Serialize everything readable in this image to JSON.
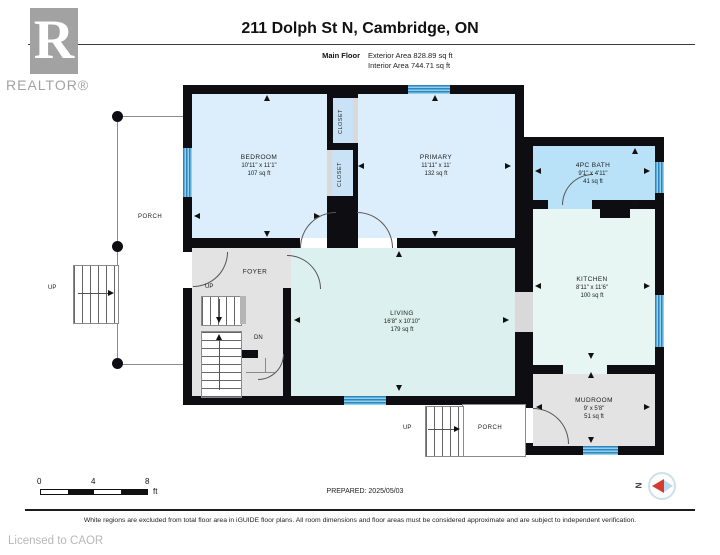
{
  "header": {
    "title": "211 Dolph St N, Cambridge, ON",
    "floor_label": "Main Floor",
    "exterior_area": "Exterior Area 828.89 sq ft",
    "interior_area": "Interior Area 744.71 sq ft"
  },
  "branding": {
    "logo_letter": "R",
    "logo_text": "REALTOR®"
  },
  "rooms": {
    "bedroom": {
      "name": "BEDROOM",
      "dims": "10'11\" x 11'1\"",
      "area": "107 sq ft"
    },
    "primary": {
      "name": "PRIMARY",
      "dims": "11'11\" x 11'",
      "area": "132 sq ft"
    },
    "bath": {
      "name": "4PC BATH",
      "dims": "9'1\" x 4'11\"",
      "area": "41 sq ft"
    },
    "kitchen": {
      "name": "KITCHEN",
      "dims": "8'11\" x 11'6\"",
      "area": "100 sq ft"
    },
    "living": {
      "name": "LIVING",
      "dims": "16'8\" x 10'10\"",
      "area": "179 sq ft"
    },
    "mudroom": {
      "name": "MUDROOM",
      "dims": "9' x 5'8\"",
      "area": "51 sq ft"
    },
    "foyer": {
      "name": "FOYER"
    }
  },
  "labels": {
    "closet": "CLOSET",
    "porch": "PORCH",
    "up": "UP",
    "dn": "DN",
    "north": "N"
  },
  "scale_bar": {
    "tick0": "0",
    "tick4": "4",
    "tick8": "8",
    "unit": "ft"
  },
  "footer": {
    "prepared": "PREPARED: 2025/05/03",
    "disclaimer": "White regions are excluded from total floor area in iGUIDE floor plans. All room dimensions and floor areas must be considered approximate and are subject to independent verification.",
    "licensed_to": "Licensed to CAOR"
  },
  "colors": {
    "room_blue": "#dceefb",
    "closet_blue": "#c9e2f5",
    "bath_blue": "#b9e2f8",
    "kitchen_mint": "#e7f6f3",
    "living_cyan": "#dcf1ef",
    "gray_room": "#e3e3e3",
    "wall": "#0e0e12",
    "window_blue": "#4da6dd",
    "compass_red": "#d43b2e"
  }
}
